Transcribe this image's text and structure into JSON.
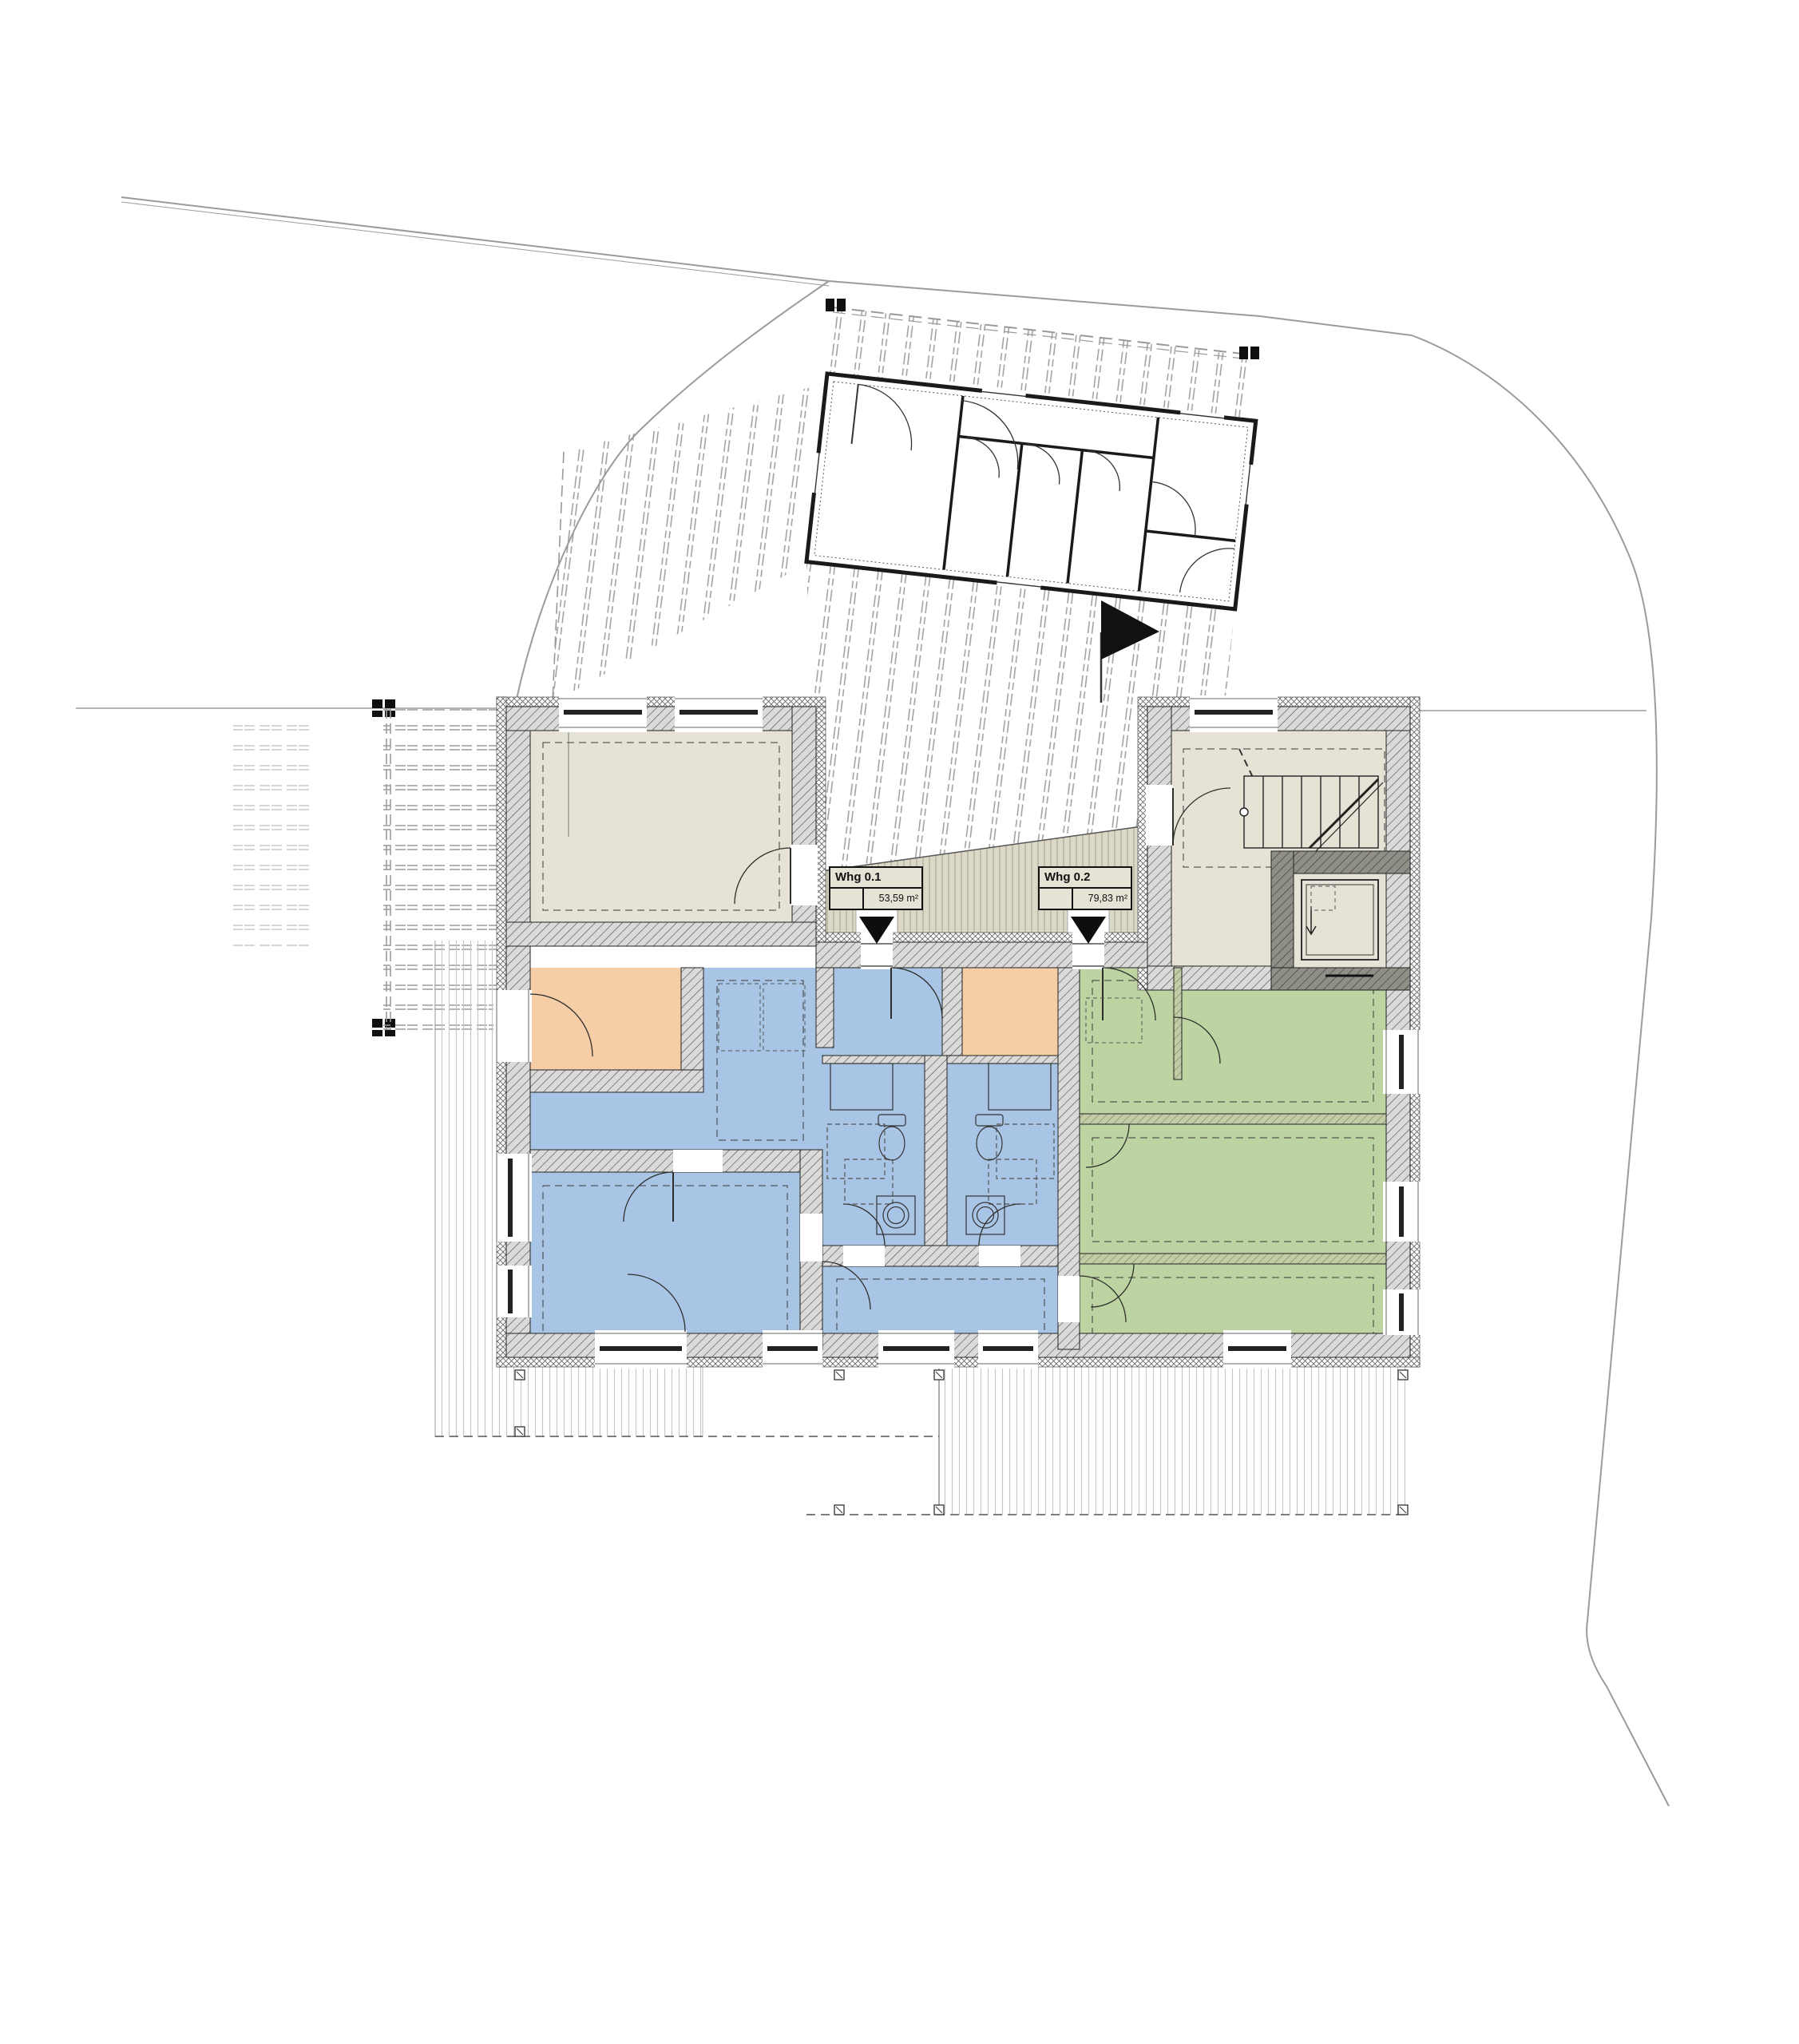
{
  "plan": {
    "apartments": [
      {
        "label": "Whg 0.1",
        "area": "53,59 m²",
        "color": "#a9c5e5"
      },
      {
        "label": "Whg 0.2",
        "area": "79,83 m²",
        "color": "#bdd3a2"
      }
    ],
    "colors": {
      "room-blue": "#a9c5e5",
      "room-green": "#bdd3a2",
      "room-orange": "#f5cda7",
      "room-beige": "#e6e2d5",
      "terrace-beige": "#dcd8c7",
      "wall-fill": "#dadad8",
      "wall-line": "#4a4a48",
      "wall-dark": "#8f8f88",
      "line-gray": "#9b9b9b",
      "ink": "#1a1a1a"
    },
    "symbols": {
      "entrance_marker": "down-triangle",
      "site_flag": "flag"
    }
  }
}
